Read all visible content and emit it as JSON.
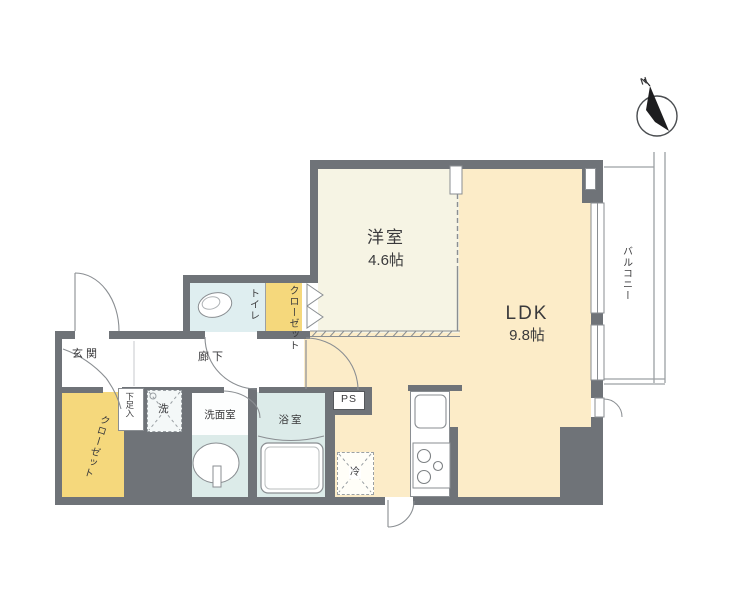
{
  "labels": {
    "western_room_name": "洋室",
    "western_room_size": "4.6帖",
    "ldk_name": "LDK",
    "ldk_size": "9.8帖",
    "balcony": "バルコニー",
    "toilet": "トイレ",
    "closet_upper": "クローゼット",
    "closet_lower": "クローゼット",
    "entrance": "玄関",
    "hallway": "廊下",
    "shoe_cabinet": "下足入",
    "washer": "洗",
    "washroom": "洗面室",
    "bathroom": "浴室",
    "pipe_space": "PS",
    "refrigerator": "冷",
    "compass_north": "N"
  },
  "colors": {
    "wall": "#6f7378",
    "ldk_floor": "#fcecc8",
    "western_floor": "#f6f4e4",
    "closet_fill": "#f5d87c",
    "washroom_floor": "#e9f2f2",
    "bathroom_floor": "#dcebe9",
    "toilet_floor": "#dfeef0",
    "line": "#888888"
  }
}
